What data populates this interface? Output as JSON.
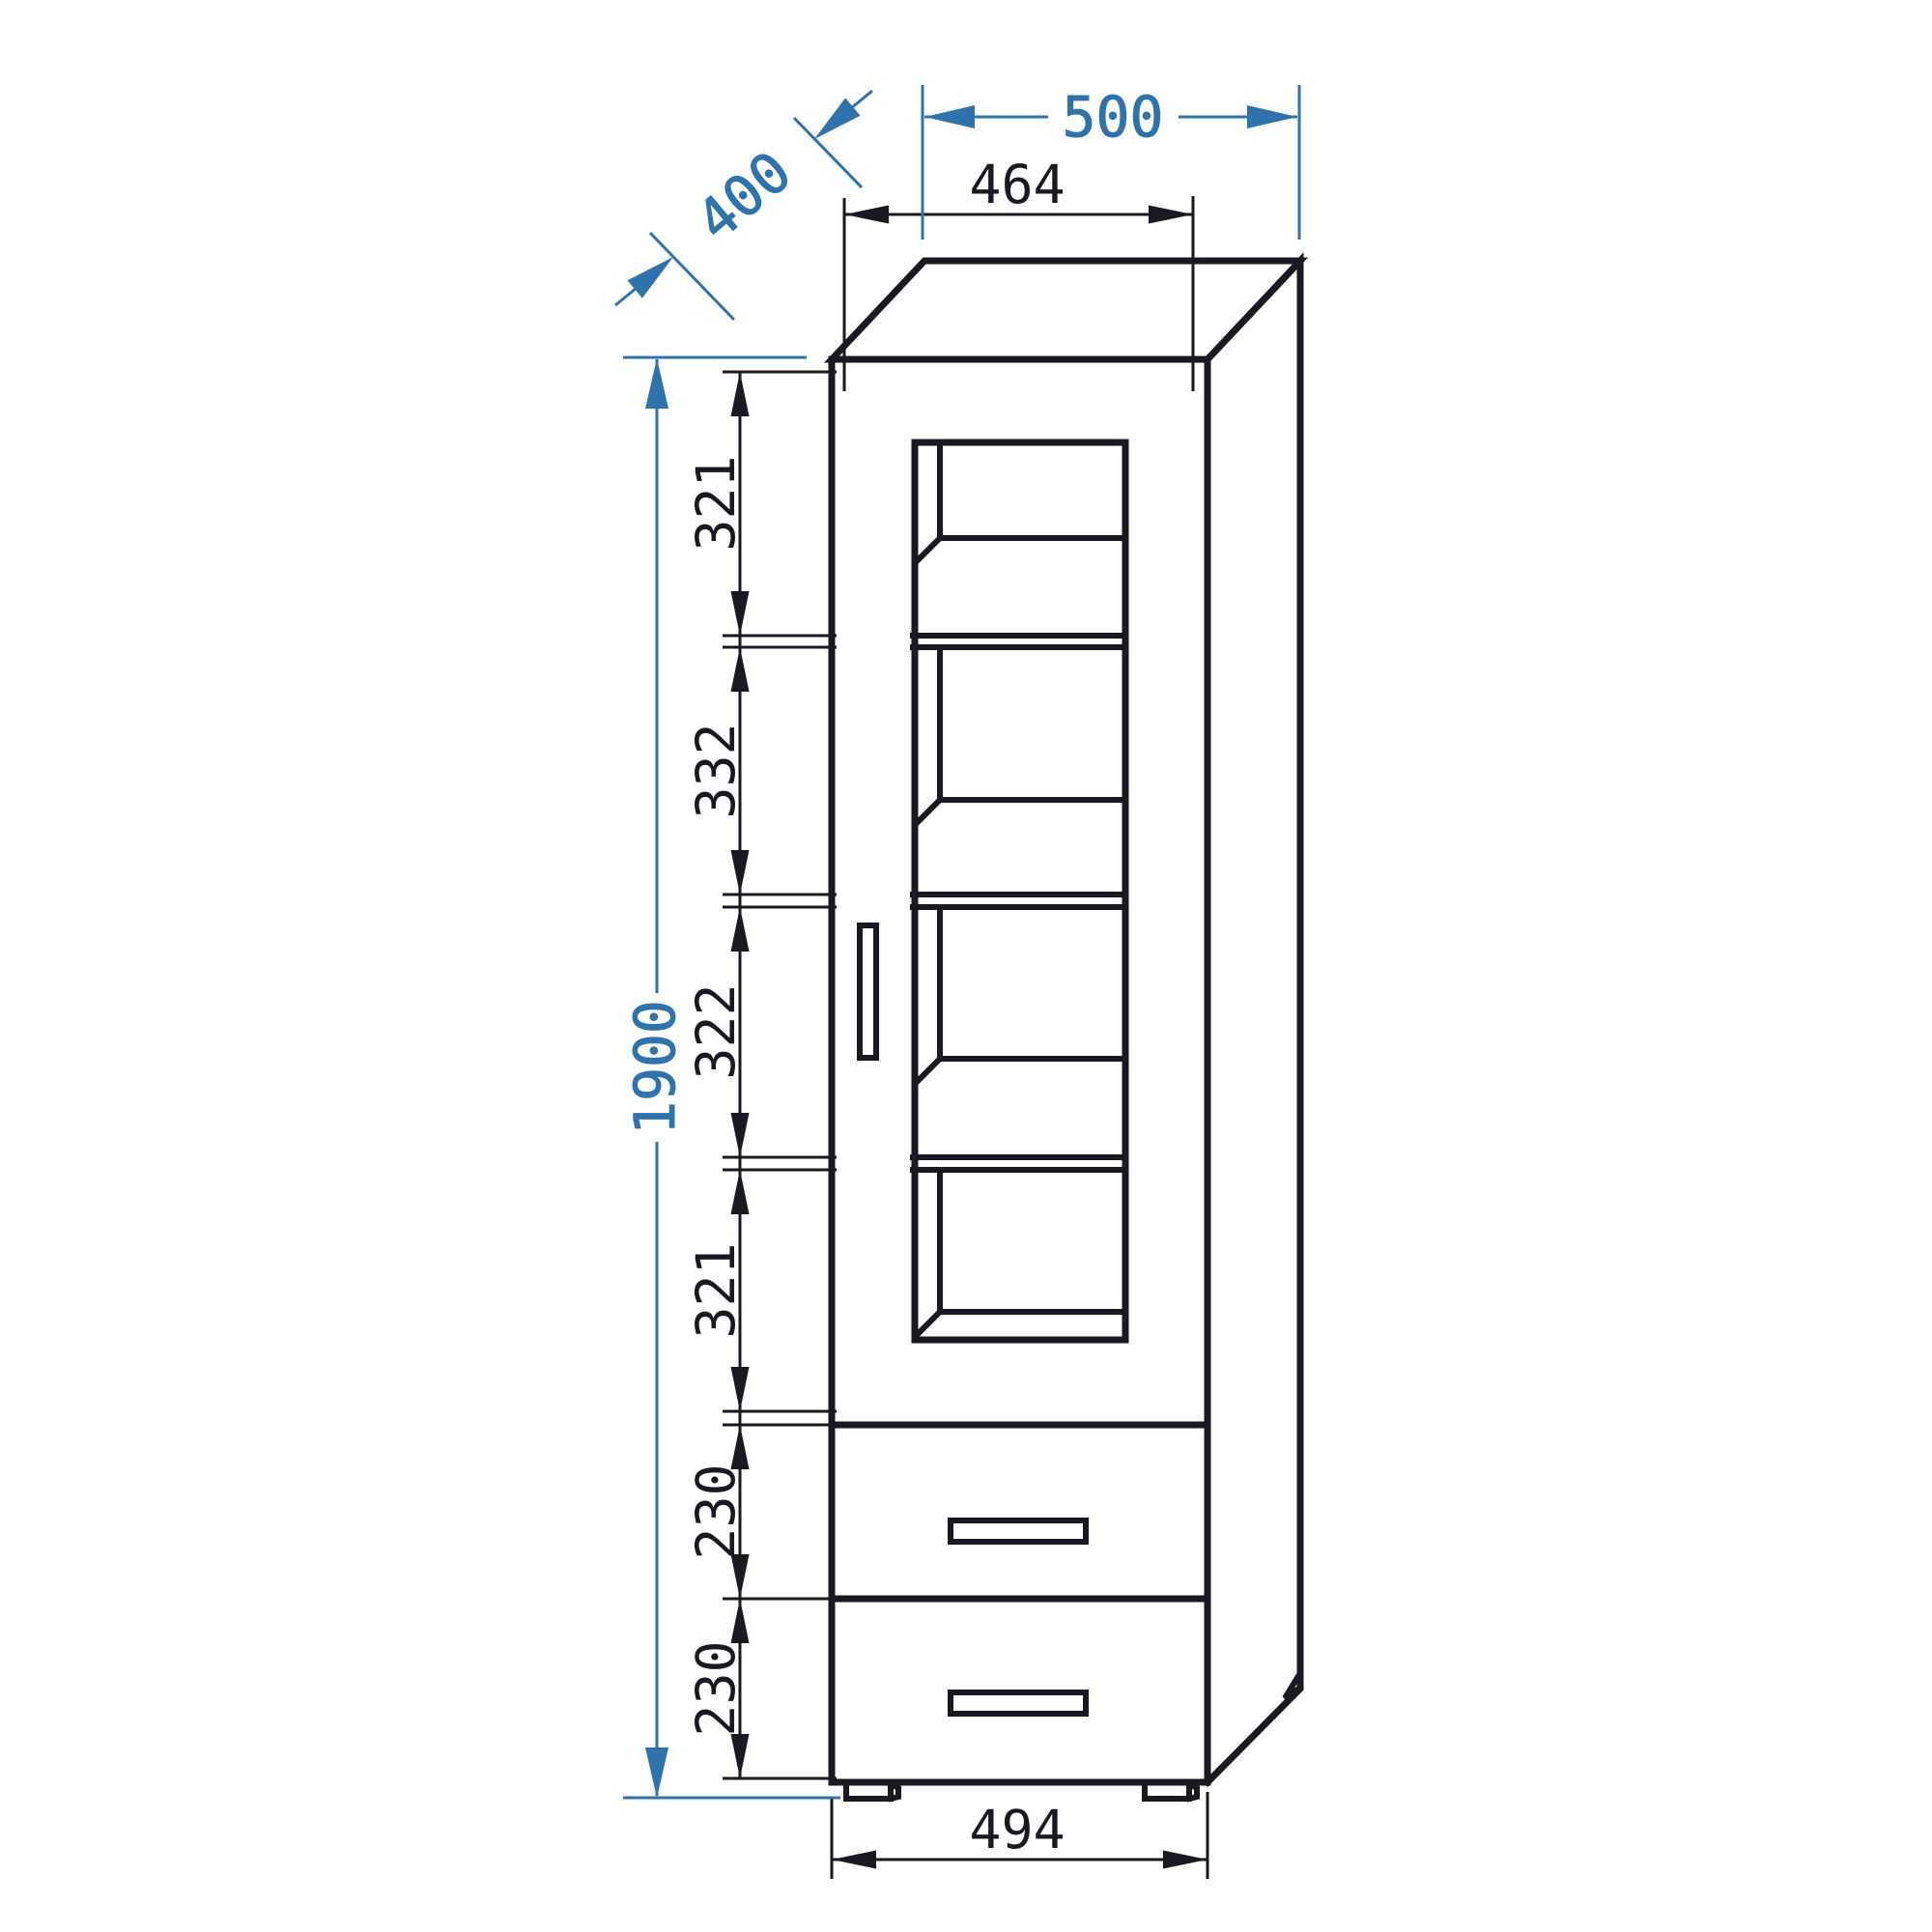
{
  "drawing": {
    "type": "furniture technical drawing",
    "subject": "tall display cabinet with glass door and two drawers",
    "background_color": "#ffffff",
    "line_color": "#191922",
    "dimension_color": "#2e73ab",
    "dimensions": {
      "overall_width": "500",
      "overall_depth": "400",
      "overall_height": "1900",
      "inner_top_width": "464",
      "body_width": "494",
      "compartment_heights": [
        "321",
        "332",
        "322",
        "321"
      ],
      "drawer_heights": [
        "230",
        "230"
      ]
    }
  }
}
